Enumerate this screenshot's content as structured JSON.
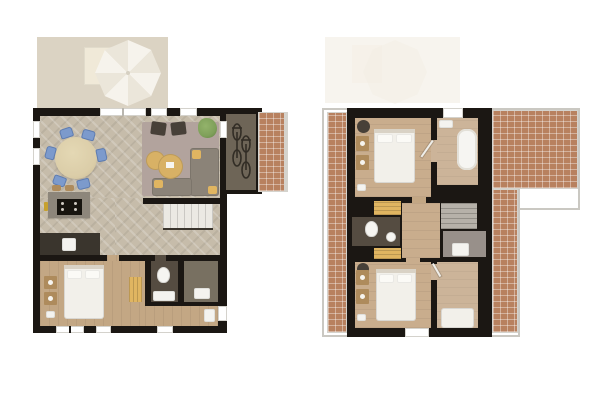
{
  "scene": {
    "kind": "floor-plan",
    "plan_count": 2,
    "style": "top-down 3D render, no text labels"
  },
  "colors": {
    "bg": "#ffffff",
    "wall": "#1b1713",
    "terrace": "#dbd3c3",
    "terrace-ghost": "#f7f4ee",
    "parasol": "#f6f3ec",
    "parasol-shade": "#ebe6da",
    "outdoor-table": "#f0e9d8",
    "floor-light": "#c6bcaa",
    "floor-warm": "#c3a784",
    "floor-warm2": "#c9ad8d",
    "floor-bath": "#ccb499",
    "carpet": "#b2a39d",
    "sofa": "#8b8378",
    "accent-yellow": "#e0b561",
    "chair-blue": "#7c9acc",
    "chair-dark": "#474038",
    "table-round": "#dbcda8",
    "coffee-table": "#d8b165",
    "island": "#8d867b",
    "stove": "#17140f",
    "counter-dark": "#3a352d",
    "dark-room": "#6e6557",
    "tech-room": "#787061",
    "wc-floor": "#554c41",
    "alcove": "#98908a",
    "stairs-light": "#ebe9e3",
    "stairs-gray": "#b6b1a9",
    "brick": "#b8815f",
    "rail": "#d5d3cd",
    "outline": "#cac8c2",
    "bed": "#f2f0ea",
    "pillow": "#fbfaf6",
    "headboard": "#d9d2c5",
    "wood-dark": "#ae8b5c",
    "plant": "#7fa05a"
  },
  "floors": [
    {
      "name": "ground-floor-plan-left",
      "rooms": [
        {
          "name": "terrace",
          "furniture": [
            "outdoor-dining-table",
            "parasol"
          ]
        },
        {
          "name": "living-dining-room",
          "furniture": [
            "round-dining-table",
            "dining-chair x6",
            "corner-sofa",
            "yellow-cushion x3",
            "coffee-table x2",
            "armchair x2",
            "plant",
            "rug"
          ]
        },
        {
          "name": "kitchen",
          "furniture": [
            "island-with-hob",
            "bar-stool x2",
            "faucet",
            "counter-with-sink"
          ]
        },
        {
          "name": "hallway",
          "furniture": [
            "staircase"
          ]
        },
        {
          "name": "bedroom",
          "furniture": [
            "double-bed",
            "nightstand x2",
            "bench",
            "slippers"
          ]
        },
        {
          "name": "bathroom",
          "furniture": [
            "toilet",
            "washbasin"
          ]
        },
        {
          "name": "storage-room",
          "furniture": [
            "cabinet"
          ]
        },
        {
          "name": "entrance-hall",
          "furniture": [
            "doormat",
            "entrance-door"
          ]
        },
        {
          "name": "bike-shed",
          "furniture": [
            "bicycle x2"
          ]
        },
        {
          "name": "brick-patio",
          "furniture": []
        }
      ]
    },
    {
      "name": "upper-floor-plan-right",
      "rooms": [
        {
          "name": "terrace-outline-below",
          "furniture": [
            "parasol-ghost",
            "outdoor-table-ghost"
          ]
        },
        {
          "name": "bedroom-1",
          "furniture": [
            "double-bed",
            "nightstand x2",
            "round-chair",
            "bench"
          ]
        },
        {
          "name": "bathroom",
          "furniture": [
            "bathtub",
            "counter"
          ]
        },
        {
          "name": "wc",
          "furniture": [
            "toilet",
            "washbasin"
          ]
        },
        {
          "name": "landing",
          "furniture": [
            "staircase",
            "wardrobe x2",
            "dresser"
          ]
        },
        {
          "name": "bedroom-2",
          "furniture": [
            "double-bed",
            "nightstand x2",
            "round-chair"
          ]
        },
        {
          "name": "bedroom-3",
          "furniture": [
            "single-bed"
          ]
        },
        {
          "name": "roof-terrace",
          "furniture": []
        }
      ]
    }
  ]
}
